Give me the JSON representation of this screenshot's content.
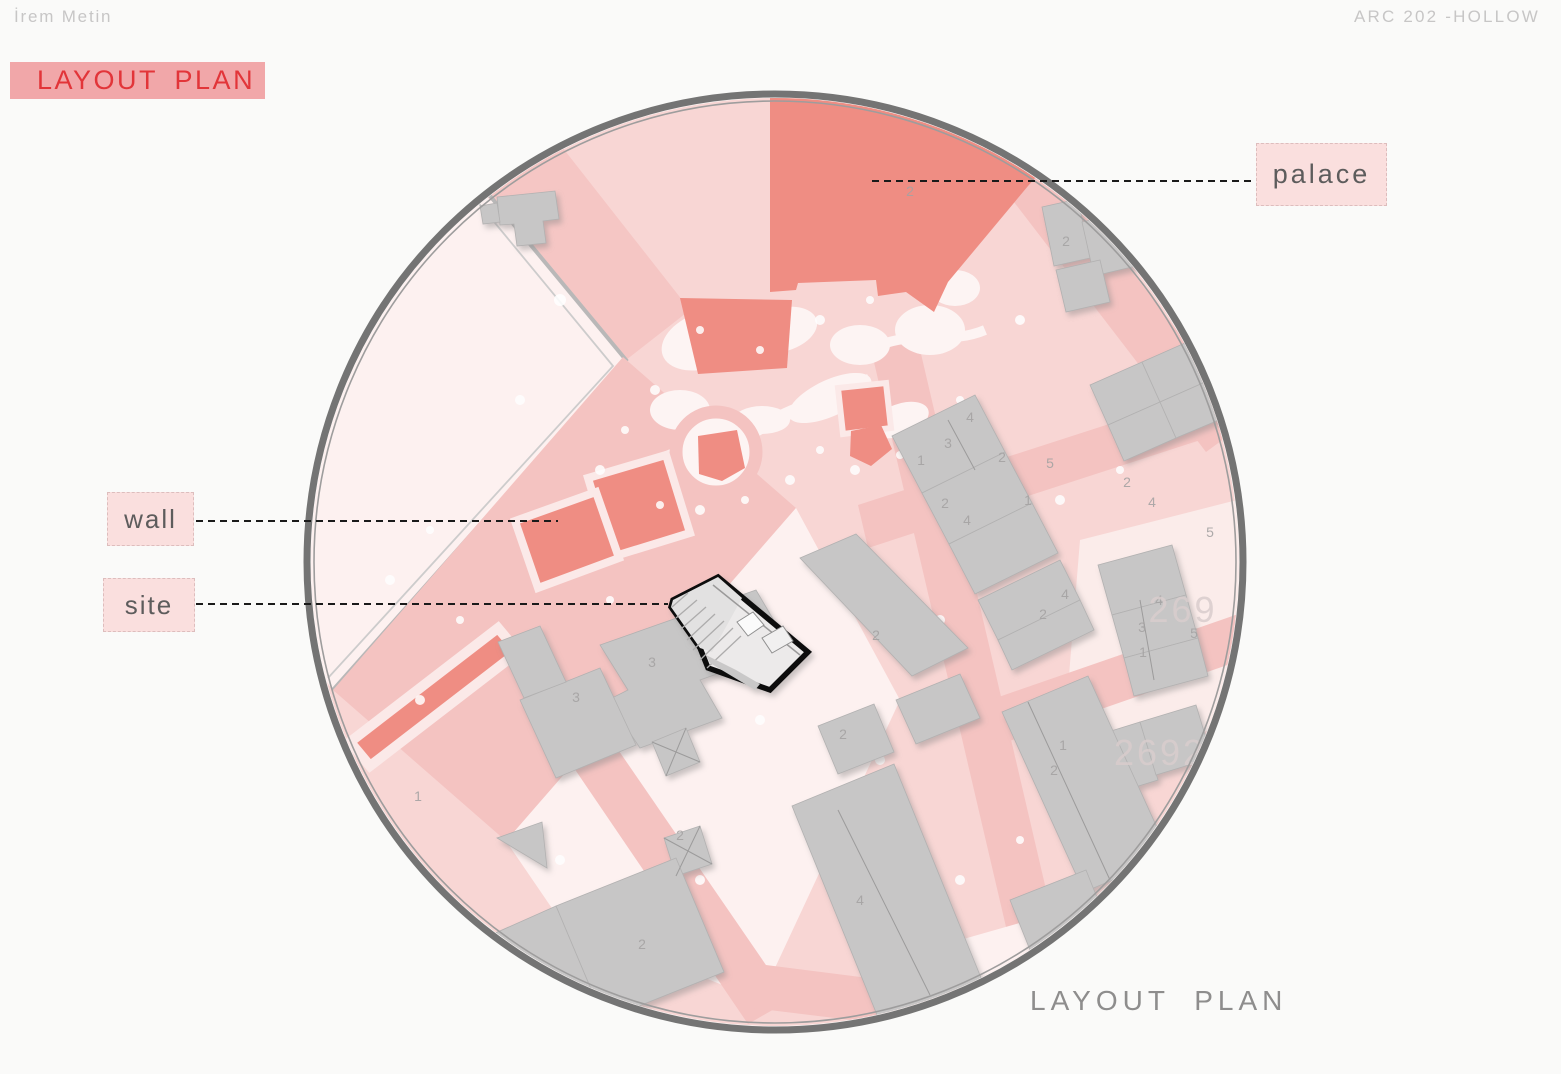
{
  "header": {
    "author": "İrem Metin",
    "course": "ARC 202 -HOLLOW"
  },
  "title_badge": {
    "label": "LAYOUT PLAN"
  },
  "caption": {
    "label": "LAYOUT PLAN"
  },
  "callouts": {
    "palace": {
      "label": "palace"
    },
    "wall": {
      "label": "wall"
    },
    "site": {
      "label": "site"
    }
  },
  "map": {
    "type": "circular-site-plan",
    "colors": {
      "accent_red": "#e23539",
      "badge_bg": "#f1a7a9",
      "label_bg": "#fadfde",
      "salmon_highlight": "#ef8d83",
      "road_pink": "#f4c3c1",
      "block_pink": "#f8d6d4",
      "pale_area": "#fdf1f0",
      "building_gray": "#c7c6c6",
      "ring_gray": "#747474",
      "site_outline": "#0d0d0d"
    },
    "block_ids": [
      {
        "t": "269",
        "x": 1183,
        "y": 622
      },
      {
        "t": "2692",
        "x": 1160,
        "y": 765
      }
    ],
    "parcel_numbers": [
      {
        "t": "2",
        "x": 1066,
        "y": 246
      },
      {
        "t": "1",
        "x": 921,
        "y": 465
      },
      {
        "t": "3",
        "x": 948,
        "y": 448
      },
      {
        "t": "4",
        "x": 970,
        "y": 422
      },
      {
        "t": "2",
        "x": 1002,
        "y": 462
      },
      {
        "t": "2",
        "x": 945,
        "y": 508
      },
      {
        "t": "4",
        "x": 967,
        "y": 525
      },
      {
        "t": "1",
        "x": 1028,
        "y": 505
      },
      {
        "t": "2",
        "x": 1127,
        "y": 487
      },
      {
        "t": "4",
        "x": 1152,
        "y": 507
      },
      {
        "t": "5",
        "x": 1210,
        "y": 537
      },
      {
        "t": "4",
        "x": 1065,
        "y": 599
      },
      {
        "t": "2",
        "x": 1043,
        "y": 619
      },
      {
        "t": "4",
        "x": 1159,
        "y": 605
      },
      {
        "t": "3",
        "x": 1142,
        "y": 632
      },
      {
        "t": "5",
        "x": 1194,
        "y": 638
      },
      {
        "t": "1",
        "x": 1143,
        "y": 657
      },
      {
        "t": "3",
        "x": 652,
        "y": 667
      },
      {
        "t": "3",
        "x": 576,
        "y": 702
      },
      {
        "t": "2",
        "x": 876,
        "y": 640
      },
      {
        "t": "2",
        "x": 680,
        "y": 840
      },
      {
        "t": "1",
        "x": 418,
        "y": 801
      },
      {
        "t": "2",
        "x": 843,
        "y": 739
      },
      {
        "t": "2",
        "x": 642,
        "y": 949
      },
      {
        "t": "4",
        "x": 860,
        "y": 905
      },
      {
        "t": "1",
        "x": 1063,
        "y": 750
      },
      {
        "t": "2",
        "x": 1054,
        "y": 775
      },
      {
        "t": "5",
        "x": 1050,
        "y": 468
      },
      {
        "t": "2",
        "x": 910,
        "y": 196
      }
    ]
  }
}
